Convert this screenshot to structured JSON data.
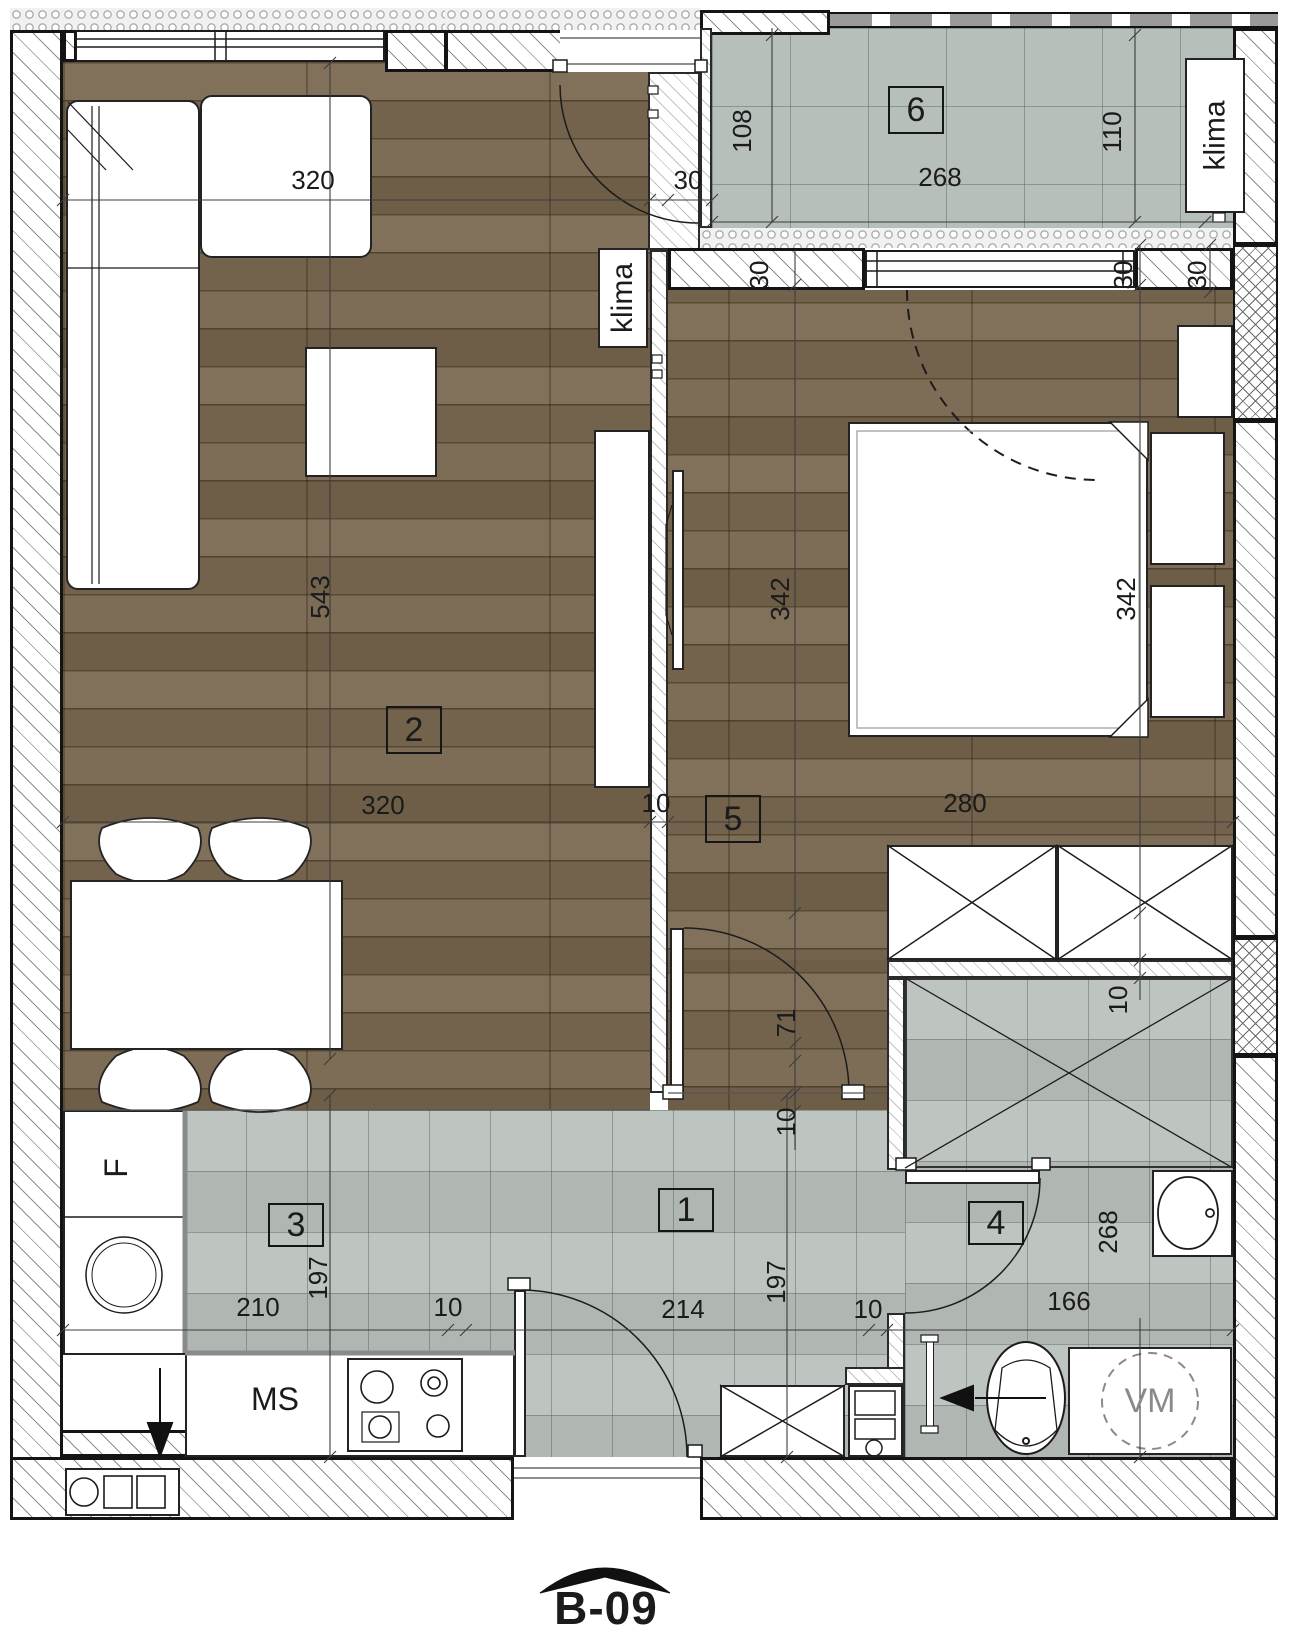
{
  "plan": {
    "unit_label": "B-09"
  },
  "rooms": [
    {
      "number": "1"
    },
    {
      "number": "2"
    },
    {
      "number": "3"
    },
    {
      "number": "4"
    },
    {
      "number": "5"
    },
    {
      "number": "6"
    }
  ],
  "labels": {
    "klima_living": "klima",
    "klima_balcony": "klima",
    "fridge": "F",
    "kitchen_unit": "MS",
    "washing_machine": "VM"
  },
  "dimensions": {
    "living_width_top": "320",
    "living_height": "543",
    "living_width": "320",
    "partition_wall": "10",
    "bedroom_width": "280",
    "bedroom_height_left": "342",
    "bedroom_height_right": "342",
    "door_width": "71",
    "door_wall": "10",
    "balcony_depth_left": "108",
    "balcony_depth_right": "110",
    "balcony_width": "268",
    "balcony_wall": "30",
    "window_wall_left": "30",
    "window_wall_right": "30",
    "window_wall_corner": "30",
    "kitchen_width": "210",
    "kitchen_depth": "197",
    "kitchen_gap": "10",
    "hall_width": "214",
    "hall_depth": "197",
    "hall_wall": "10",
    "bath_width": "166",
    "bath_height": "268",
    "bath_wall": "10"
  }
}
